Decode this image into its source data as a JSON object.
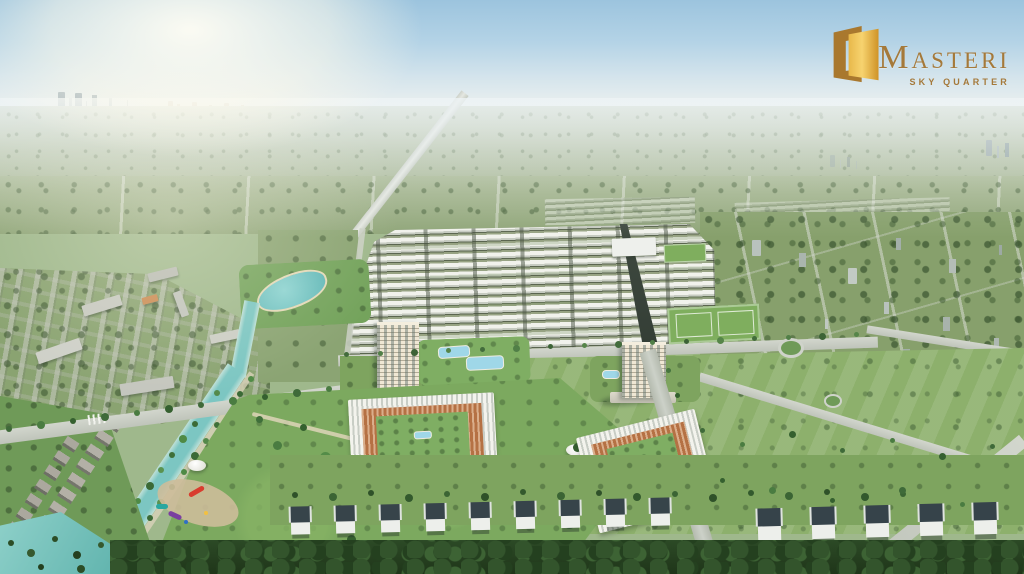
{
  "brand": {
    "initial": "M",
    "rest": "ASTERI",
    "tagline": "SKY QUARTER"
  },
  "palette": {
    "brand_gold_dark": "#A9782E",
    "brand_gold_light": "#F7D36F",
    "brand_text": "#A5793A",
    "sky_blue": "#9CC4DE",
    "horizon_haze": "#EEF4F6",
    "field_green": "#8DB06C",
    "park_green": "#7CA95F",
    "canal_water": "#7CC6C2",
    "road_gray": "#C9CEC6",
    "townhouse_roof_white": "#F1F2EC",
    "villa_roof_dark": "#37444A",
    "shophouse_orange": "#B57144",
    "tower_cream": "#EFE7D4"
  }
}
